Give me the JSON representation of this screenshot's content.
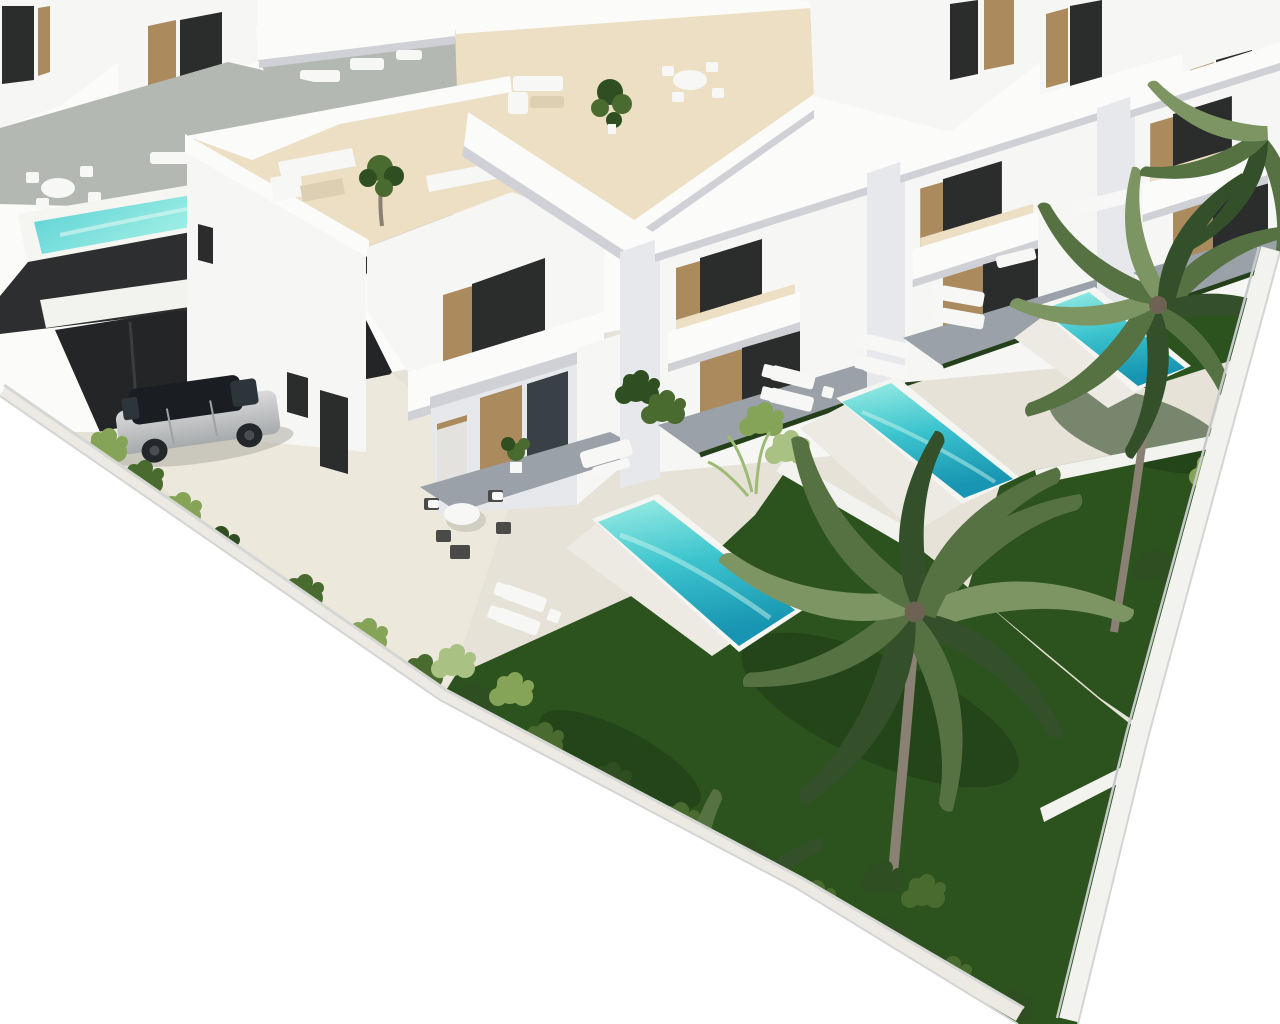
{
  "image": {
    "kind": "architectural-3d-render",
    "view": "aerial-isometric",
    "subject": "row of modern white villas with private pools, gardens, palm trees and rooftop terraces"
  },
  "palette": {
    "bg": "#ffffff",
    "wallWhite": "#f6f6f4",
    "wallBright": "#fbfbfa",
    "wallShade": "#e7e8eb",
    "shadowLine": "#cfd1d6",
    "roofFloor": "#ecdfc3",
    "roofShade": "#ddd0b2",
    "paving": "#e6e2d7",
    "pavingWarm": "#ece8dc",
    "slate": "#9aa1a8",
    "slateDark": "#878f97",
    "deckGray": "#b3b9b2",
    "poolLight": "#9cede4",
    "poolMid": "#3cc4ce",
    "poolDeep": "#1895b2",
    "poolRim": "#f5f5f2",
    "grassDark": "#1e3a15",
    "grassMid": "#2c521d",
    "grassLight": "#3e6b2a",
    "bushDark": "#2f4f22",
    "bushMid": "#4a6b2f",
    "bushLight": "#86a457",
    "bushPale": "#a9c284",
    "frondDark": "#33502a",
    "frondMid": "#567243",
    "frondLight": "#7d9562",
    "trunk": "#8a8174",
    "wood": "#ab8a5e",
    "glassDark": "#2b2d2c",
    "glassBlue": "#3a4146",
    "charcoal": "#2c2e2f",
    "charcoalDeep": "#232526",
    "carSilver": "#c9cbcd",
    "carDark": "#1d2125",
    "furnWhite": "#f7f7f5",
    "furnShadow": "#b5b3a8",
    "pathLight": "#eceae3",
    "wallCap": "#f2f2ef",
    "edgeLine": "#d3d5d4"
  },
  "scene": {
    "front_row_villas": 4,
    "back_row_structures": 5,
    "garden_pools": 3,
    "elevated_pool": 1,
    "large_palm_trees": 2,
    "small_palm_clusters": 3,
    "cars": 1,
    "garage_doors": 2,
    "rooftop_terraces": true,
    "sun_loungers_groups": 5,
    "outdoor_dining_sets": 3,
    "perimeter_wall": "white, runs along right and bottom-left edges",
    "background": "plain white"
  }
}
